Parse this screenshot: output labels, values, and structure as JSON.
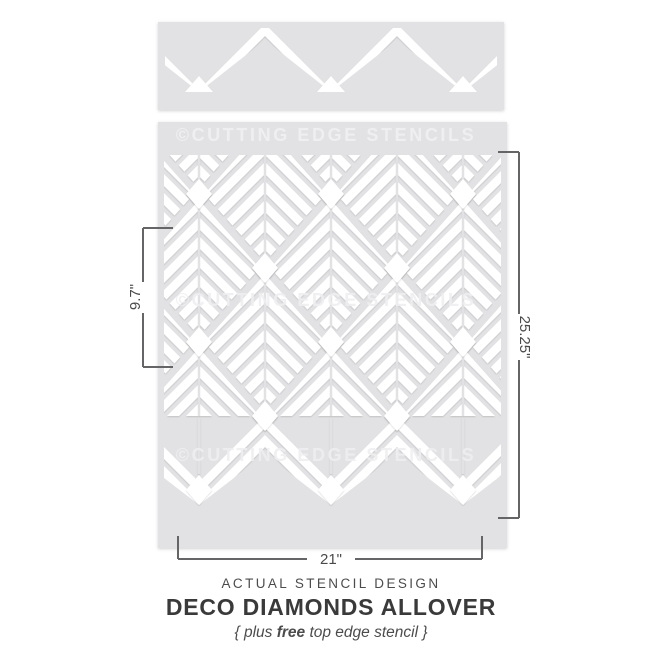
{
  "stencil": {
    "watermark": "©CUTTING EDGE STENCILS",
    "material_color": "#e2e2e4",
    "cutout_color": "#ffffff"
  },
  "dimensions": {
    "repeat_height": "9.7\"",
    "sheet_height": "25.25\"",
    "sheet_width": "21\"",
    "line_color": "#656567"
  },
  "captions": {
    "kicker": "ACTUAL STENCIL DESIGN",
    "title": "DECO DIAMONDS ALLOVER",
    "sub_prefix": "{ plus ",
    "sub_bold": "free",
    "sub_suffix": " top edge stencil }"
  }
}
